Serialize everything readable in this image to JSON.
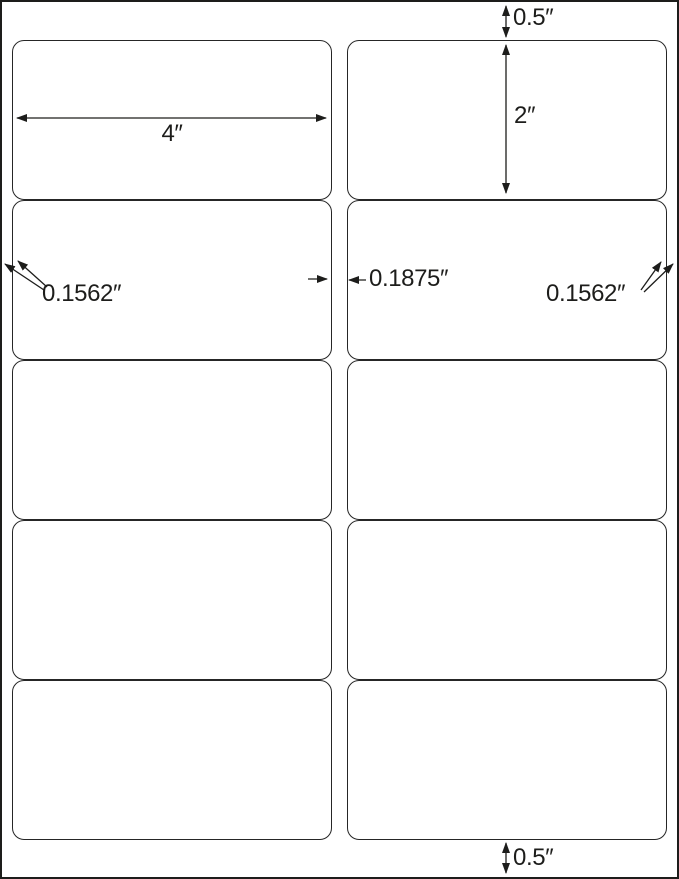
{
  "page": {
    "background_color": "#ffffff",
    "border_color": "#1d1d1b",
    "line_color": "#1d1d1b",
    "label_border_color": "#262626"
  },
  "sheet": {
    "columns": 2,
    "rows": 5,
    "label_count": 10
  },
  "dimensions": {
    "top_margin": {
      "label": "0.5″"
    },
    "label_width": {
      "label": "4″"
    },
    "label_height": {
      "label": "2″"
    },
    "left_margin": {
      "label": "0.1562″"
    },
    "column_gap": {
      "label": "0.1875″"
    },
    "right_margin": {
      "label": "0.1562″"
    },
    "bottom_margin": {
      "label": "0.5″"
    }
  }
}
